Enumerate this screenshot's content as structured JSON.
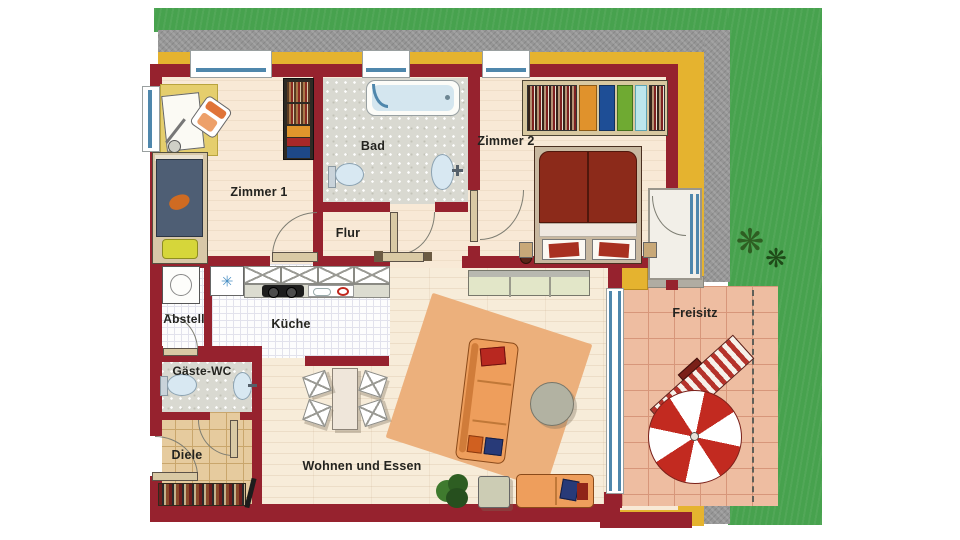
{
  "rooms": [
    {
      "name": "zimmer-1",
      "label": "Zimmer 1"
    },
    {
      "name": "bad",
      "label": "Bad"
    },
    {
      "name": "zimmer-2",
      "label": "Zimmer 2"
    },
    {
      "name": "flur",
      "label": "Flur"
    },
    {
      "name": "abstell",
      "label": "Abstell"
    },
    {
      "name": "kueche",
      "label": "Küche"
    },
    {
      "name": "gaeste-wc",
      "label": "Gäste-WC"
    },
    {
      "name": "diele",
      "label": "Diele"
    },
    {
      "name": "wohnen-essen",
      "label": "Wohnen und Essen"
    },
    {
      "name": "freisitz",
      "label": "Freisitz"
    }
  ],
  "symbols": {
    "freezer": "✳",
    "plant": "❋"
  },
  "colors": {
    "wall": "#96222e",
    "accent_band": "#e5b32f",
    "grass": "#47a24e",
    "gravel": "#969696",
    "floor_cream": "#f8e9d6",
    "bath_tile": "#d9d9d1",
    "diele_tile": "#e6cb9e",
    "terrace_tile": "#eebda1",
    "window_blue": "#4f87ac",
    "rug": "#ecb07c",
    "sofa": "#ee9e5c",
    "bed1_blanket": "#4e5e74",
    "bed2_blanket": "#8c2a1a",
    "umbrella_red": "#c22a20",
    "plant_green": "#2e5e22"
  }
}
